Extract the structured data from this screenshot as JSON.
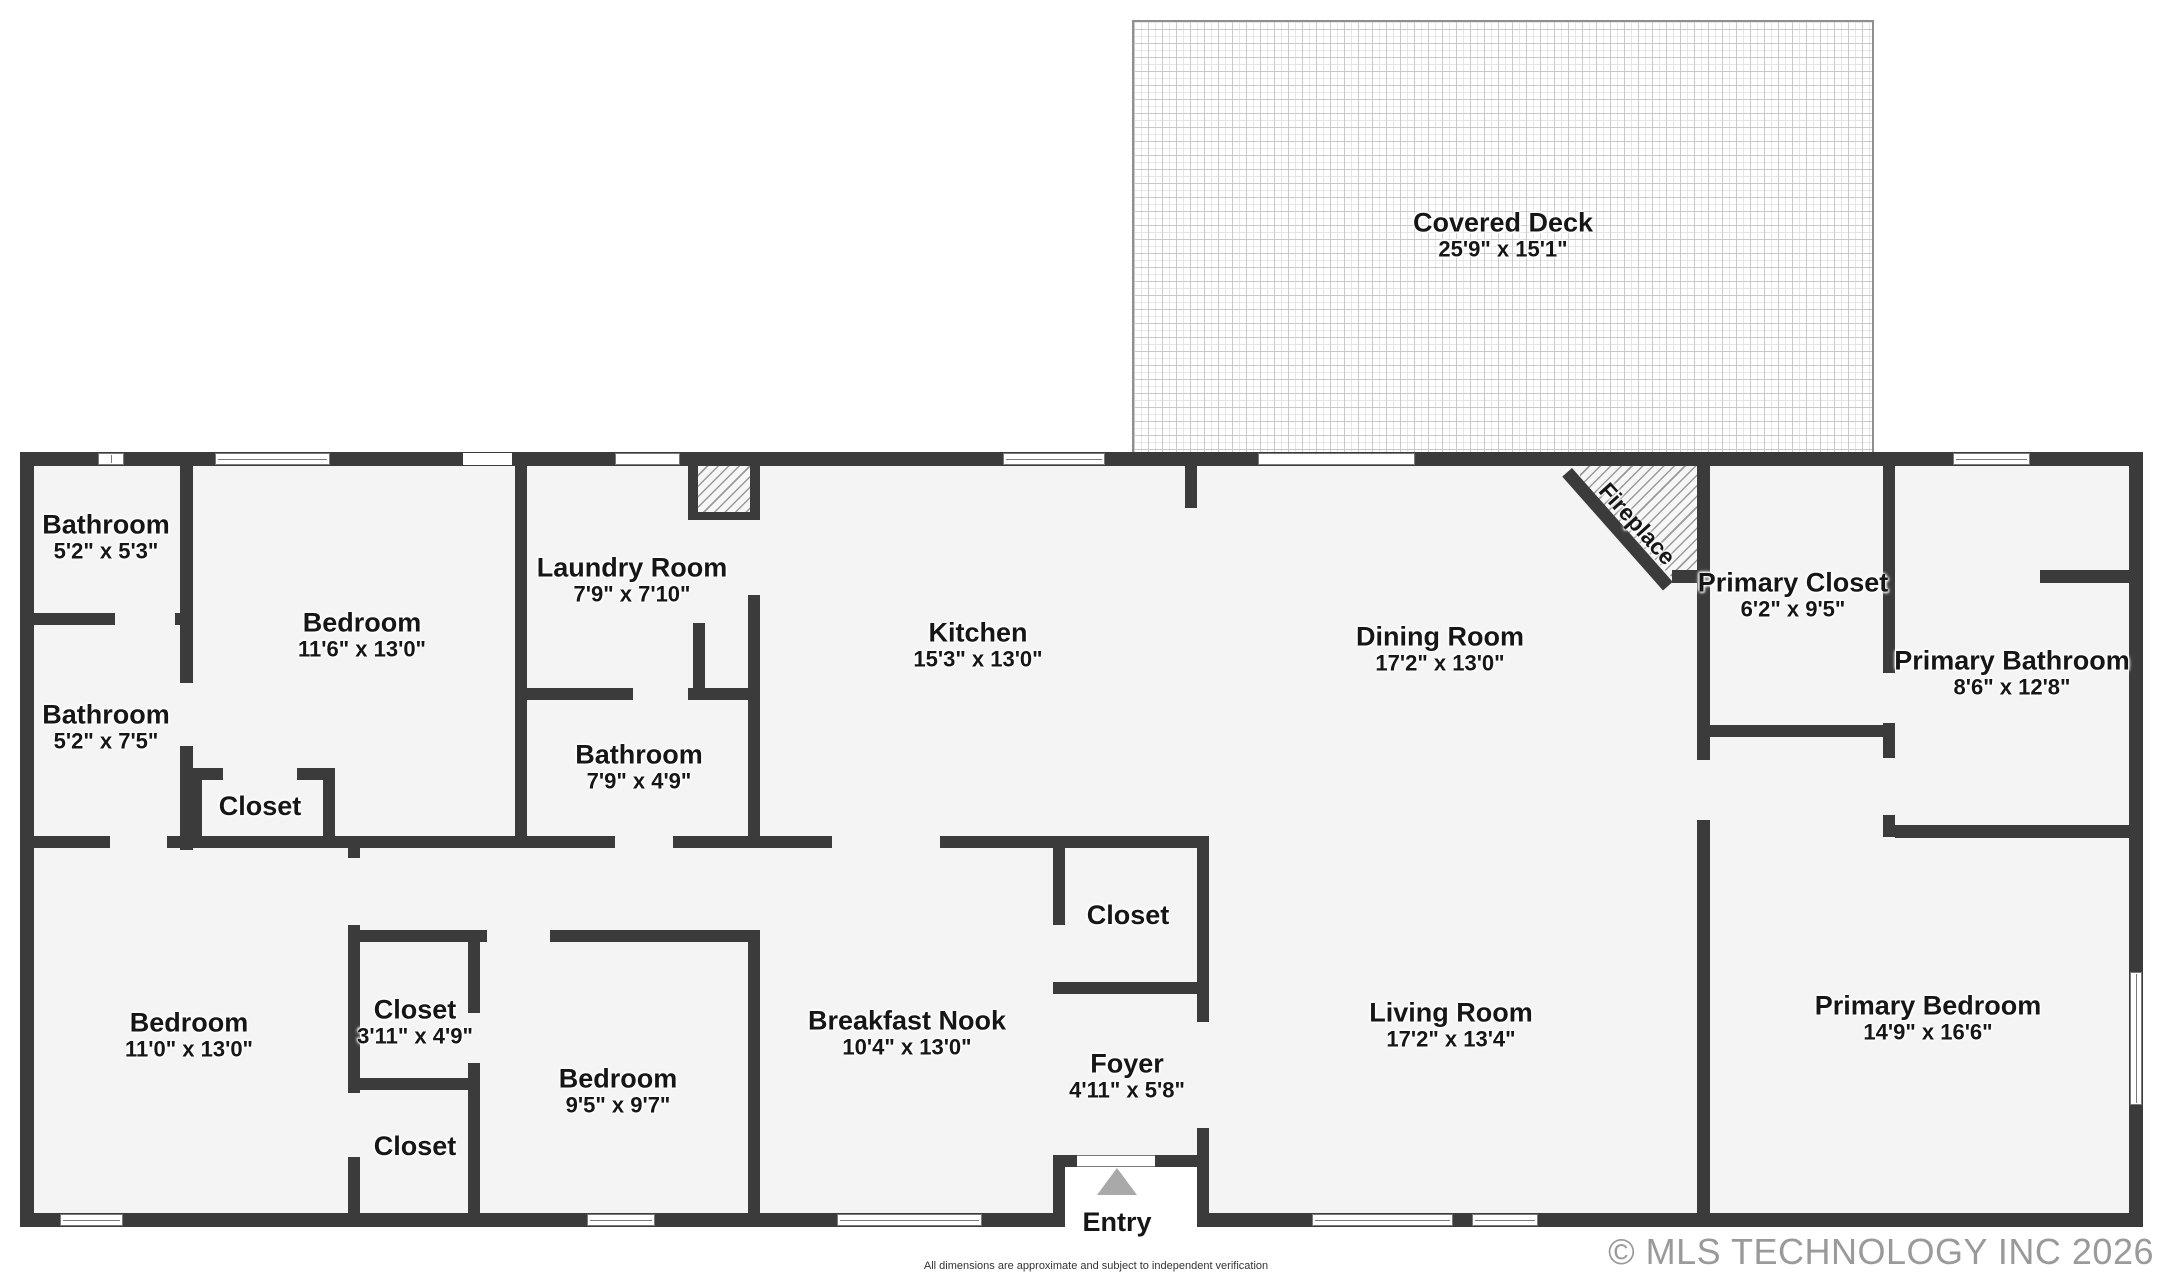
{
  "rooms": {
    "covered_deck": {
      "name": "Covered Deck",
      "dims": "25'9\" x 15'1\""
    },
    "bathroom_top": {
      "name": "Bathroom",
      "dims": "5'2\" x 5'3\""
    },
    "bathroom_mid": {
      "name": "Bathroom",
      "dims": "5'2\" x 7'5\""
    },
    "bedroom_upper": {
      "name": "Bedroom",
      "dims": "11'6\" x 13'0\""
    },
    "laundry": {
      "name": "Laundry Room",
      "dims": "7'9\" x 7'10\""
    },
    "bathroom_small": {
      "name": "Bathroom",
      "dims": "7'9\" x 4'9\""
    },
    "kitchen": {
      "name": "Kitchen",
      "dims": "15'3\" x 13'0\""
    },
    "dining": {
      "name": "Dining Room",
      "dims": "17'2\" x 13'0\""
    },
    "primary_closet": {
      "name": "Primary Closet",
      "dims": "6'2\" x 9'5\""
    },
    "primary_bathroom": {
      "name": "Primary Bathroom",
      "dims": "8'6\" x 12'8\""
    },
    "closet_hall": {
      "name": "Closet"
    },
    "bedroom_left": {
      "name": "Bedroom",
      "dims": "11'0\" x 13'0\""
    },
    "closet_1": {
      "name": "Closet",
      "dims": "3'11\" x 4'9\""
    },
    "closet_2": {
      "name": "Closet"
    },
    "bedroom_small": {
      "name": "Bedroom",
      "dims": "9'5\" x 9'7\""
    },
    "breakfast_nook": {
      "name": "Breakfast Nook",
      "dims": "10'4\" x 13'0\""
    },
    "closet_foyer": {
      "name": "Closet"
    },
    "foyer": {
      "name": "Foyer",
      "dims": "4'11\" x 5'8\""
    },
    "living": {
      "name": "Living Room",
      "dims": "17'2\" x 13'4\""
    },
    "primary_bedroom": {
      "name": "Primary Bedroom",
      "dims": "14'9\" x 16'6\""
    }
  },
  "annotations": {
    "fireplace": "Fireplace",
    "entry": "Entry"
  },
  "footer": {
    "disclaimer": "All dimensions are approximate and subject to independent verification",
    "copyright": "© MLS TECHNOLOGY INC 2026"
  },
  "colors": {
    "wall": "#3b3b3b",
    "room_fill": "#f4f4f4",
    "entry_arrow": "#a9a9a9",
    "copyright_text": "#9a9a9a"
  }
}
